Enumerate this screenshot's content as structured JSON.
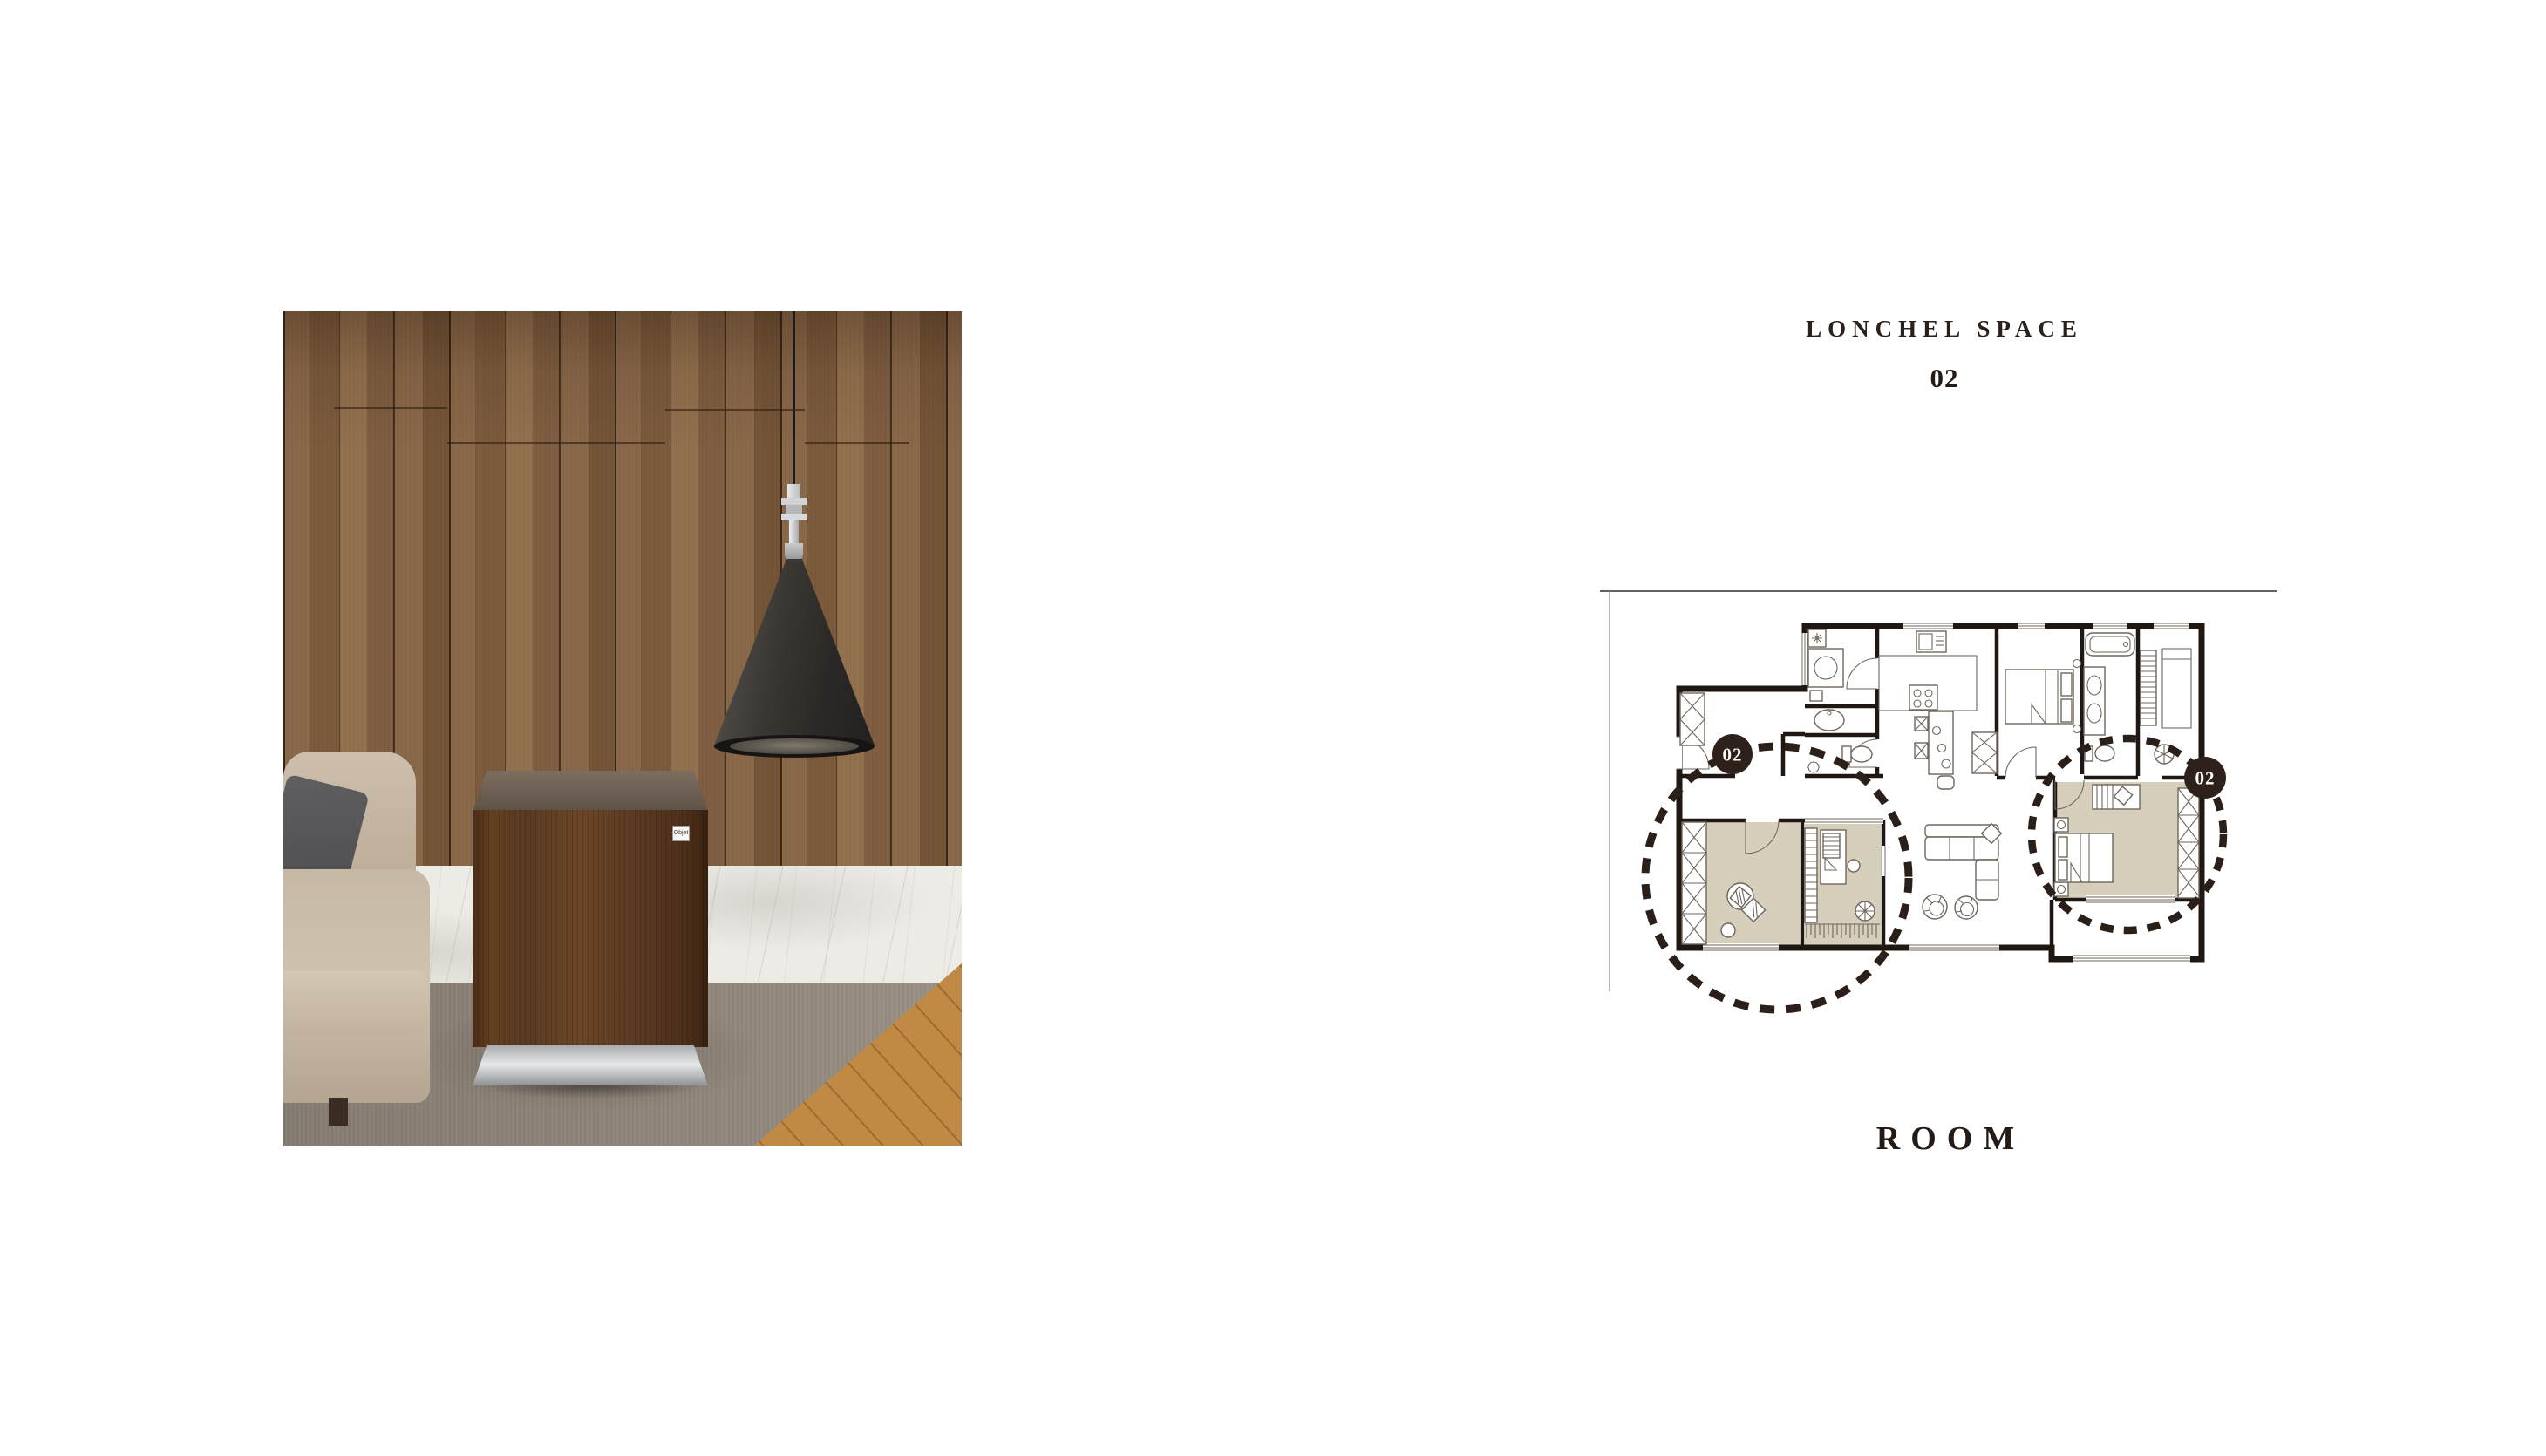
{
  "header": {
    "brand": "LONCHEL SPACE",
    "index": "02"
  },
  "caption": {
    "title": "ROOM"
  },
  "photo": {
    "product_label": "Objet"
  },
  "floor_plan": {
    "badges": [
      {
        "label": "02"
      },
      {
        "label": "02"
      }
    ],
    "highlight_color": "#d6cfbc",
    "wall_color": "#1f1712",
    "badge_color": "#2e211b",
    "dashed_circle_color": "#2b2019"
  },
  "colors": {
    "background": "#ffffff",
    "text_dark": "#241b15",
    "wood_wall": "#87664a",
    "marble": "#edebe6",
    "rug": "#8e857b",
    "wood_floor": "#c08a45",
    "cabinet": "#5b3a24",
    "sofa": "#c6b8a4",
    "lamp_shade": "#2b2825"
  }
}
